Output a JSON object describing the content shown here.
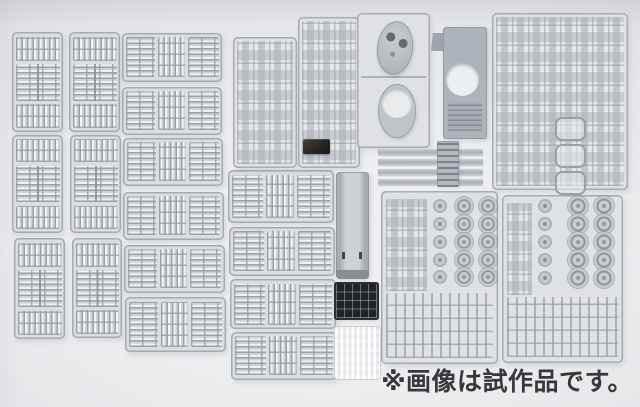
{
  "caption": {
    "text": "※画像は試作品です。"
  },
  "palette": {
    "background": "#ebecee",
    "sprue_plastic": "#c6cacf",
    "part_highlight": "#f1f3f4",
    "frame_gray": "#9ba1a8",
    "hull_gray": "#adb3ba",
    "grille_black": "#202327",
    "dark_part": "#262322",
    "caption_color": "#38383c"
  },
  "scene": {
    "width": 640,
    "height": 407,
    "sprues": [
      {
        "id": "a1",
        "kind": "track-v",
        "x": 12,
        "y": 32,
        "w": 51,
        "h": 100
      },
      {
        "id": "a2",
        "kind": "track-v",
        "x": 12,
        "y": 135,
        "w": 51,
        "h": 98
      },
      {
        "id": "a3",
        "kind": "track-v",
        "x": 14,
        "y": 238,
        "w": 51,
        "h": 101
      },
      {
        "id": "b1",
        "kind": "track-v",
        "x": 69,
        "y": 32,
        "w": 51,
        "h": 100
      },
      {
        "id": "b2",
        "kind": "track-v",
        "x": 70,
        "y": 135,
        "w": 51,
        "h": 98
      },
      {
        "id": "b3",
        "kind": "track-v",
        "x": 72,
        "y": 238,
        "w": 50,
        "h": 100
      },
      {
        "id": "c1",
        "kind": "track-h",
        "x": 122,
        "y": 33,
        "w": 100,
        "h": 49
      },
      {
        "id": "c2",
        "kind": "track-h",
        "x": 122,
        "y": 87,
        "w": 100,
        "h": 48
      },
      {
        "id": "c3",
        "kind": "track-h",
        "x": 123,
        "y": 138,
        "w": 100,
        "h": 48
      },
      {
        "id": "c4",
        "kind": "track-h",
        "x": 123,
        "y": 192,
        "w": 101,
        "h": 48
      },
      {
        "id": "c5",
        "kind": "track-h",
        "x": 124,
        "y": 245,
        "w": 101,
        "h": 48
      },
      {
        "id": "c6",
        "kind": "track-h",
        "x": 125,
        "y": 297,
        "w": 101,
        "h": 55
      },
      {
        "id": "d1",
        "kind": "track-h",
        "x": 228,
        "y": 170,
        "w": 106,
        "h": 53
      },
      {
        "id": "d2",
        "kind": "track-h",
        "x": 229,
        "y": 227,
        "w": 106,
        "h": 49
      },
      {
        "id": "d3",
        "kind": "track-h",
        "x": 230,
        "y": 279,
        "w": 106,
        "h": 50
      },
      {
        "id": "d4",
        "kind": "track-h",
        "x": 231,
        "y": 332,
        "w": 106,
        "h": 48
      },
      {
        "id": "e1",
        "kind": "parts",
        "x": 233,
        "y": 37,
        "w": 64,
        "h": 131
      },
      {
        "id": "e2",
        "kind": "parts",
        "x": 298,
        "y": 17,
        "w": 62,
        "h": 151
      },
      {
        "id": "i1",
        "kind": "parts-fenders",
        "x": 492,
        "y": 13,
        "w": 136,
        "h": 177
      },
      {
        "id": "f1",
        "kind": "turret",
        "x": 357,
        "y": 13,
        "w": 73,
        "h": 135
      },
      {
        "id": "g1",
        "kind": "hulldeck",
        "x": 431,
        "y": 27,
        "w": 56,
        "h": 113
      },
      {
        "id": "s1",
        "kind": "strip",
        "x": 378,
        "y": 149,
        "w": 105,
        "h": 6
      },
      {
        "id": "s2",
        "kind": "strip",
        "x": 378,
        "y": 159,
        "w": 105,
        "h": 6
      },
      {
        "id": "s3",
        "kind": "strip",
        "x": 378,
        "y": 169,
        "w": 105,
        "h": 6
      },
      {
        "id": "s4",
        "kind": "strip",
        "x": 378,
        "y": 179,
        "w": 105,
        "h": 6
      },
      {
        "id": "s5",
        "kind": "ladder",
        "x": 437,
        "y": 141,
        "w": 22,
        "h": 46
      },
      {
        "id": "k1",
        "kind": "tub",
        "x": 336,
        "y": 172,
        "w": 33,
        "h": 107
      },
      {
        "id": "l1",
        "kind": "grille",
        "x": 336,
        "y": 284,
        "w": 41,
        "h": 34
      },
      {
        "id": "m1",
        "kind": "clear",
        "x": 334,
        "y": 326,
        "w": 45,
        "h": 52
      },
      {
        "id": "p1",
        "kind": "darkpart",
        "x": 303,
        "y": 139,
        "w": 27,
        "h": 15
      },
      {
        "id": "j1",
        "kind": "wheels",
        "x": 381,
        "y": 191,
        "w": 117,
        "h": 173,
        "wheels": {
          "small_x": 59,
          "big_x": [
            83,
            107
          ],
          "row_y": [
            15,
            33,
            51,
            69,
            86
          ],
          "r_big": 9,
          "r_small": 6
        }
      },
      {
        "id": "j2",
        "kind": "wheels",
        "x": 502,
        "y": 195,
        "w": 121,
        "h": 168,
        "wheels": {
          "small_x": 43,
          "big_x": [
            76,
            102
          ],
          "row_y": [
            11,
            29,
            47,
            65,
            83
          ],
          "r_big": 10,
          "r_small": 6
        }
      }
    ]
  }
}
